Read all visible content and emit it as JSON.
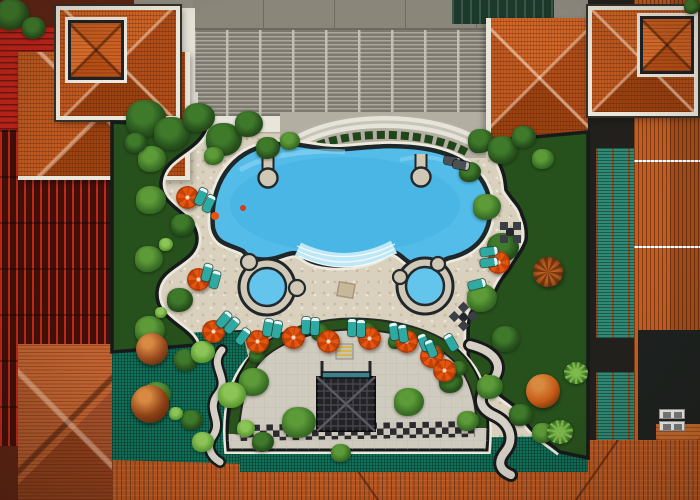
{
  "scene": {
    "description": "Aerial top-down drone photo of a tropical resort courtyard: free-form turquoise swimming pool with curved steps and two round jacuzzis, travertine sun deck with orange umbrellas and teal loungers, lush gardens, a semicircular lower courtyard with a dark pergola lattice and checkerboard path, framed by orange terracotta tower roofs, red and orange slatted pergolas, green canopy roofs and a grey louvred service building."
  },
  "colors": {
    "deck": "#d9d1be",
    "garden_paving": "#d0cbbf",
    "pool_water": "#54bce9",
    "pool_water_deep": "#3dafe0",
    "pool_steps": "#bfe8f6",
    "pool_edge": "#1e282b",
    "coping": "#eeeade",
    "roof_orange": "#bf5621",
    "red_pergola": "#c0241a",
    "building_gray": "#8f8b81",
    "mesh_green": "#10725a",
    "veg_dark": "#27511c",
    "veg_mid": "#3a7026",
    "umbrella_orange": "#e4550f",
    "lounger_teal": "#2faaa3",
    "furniture_dark": "#3a3f45",
    "white_trim": "#e9e6da"
  },
  "objects": {
    "umbrellas": [
      {
        "x": 187,
        "y": 197
      },
      {
        "x": 198,
        "y": 279
      },
      {
        "x": 213,
        "y": 331
      },
      {
        "x": 257,
        "y": 341
      },
      {
        "x": 293,
        "y": 337
      },
      {
        "x": 328,
        "y": 341
      },
      {
        "x": 369,
        "y": 338
      },
      {
        "x": 406,
        "y": 341
      },
      {
        "x": 431,
        "y": 356
      },
      {
        "x": 444,
        "y": 370
      },
      {
        "x": 498,
        "y": 262
      }
    ],
    "cone_umbrella": {
      "x": 548,
      "y": 272,
      "d": 30
    },
    "loungers": [
      {
        "x": 201,
        "y": 196,
        "rot": 25
      },
      {
        "x": 209,
        "y": 203,
        "rot": 25
      },
      {
        "x": 207,
        "y": 272,
        "rot": 15
      },
      {
        "x": 215,
        "y": 279,
        "rot": 15
      },
      {
        "x": 224,
        "y": 319,
        "rot": 40
      },
      {
        "x": 232,
        "y": 325,
        "rot": 40
      },
      {
        "x": 243,
        "y": 336,
        "rot": 35
      },
      {
        "x": 268,
        "y": 327,
        "rot": 10
      },
      {
        "x": 277,
        "y": 329,
        "rot": 10
      },
      {
        "x": 306,
        "y": 325,
        "rot": 3
      },
      {
        "x": 315,
        "y": 326,
        "rot": 3
      },
      {
        "x": 352,
        "y": 327,
        "rot": 0
      },
      {
        "x": 361,
        "y": 328,
        "rot": 0
      },
      {
        "x": 394,
        "y": 331,
        "rot": -8
      },
      {
        "x": 403,
        "y": 333,
        "rot": -8
      },
      {
        "x": 424,
        "y": 342,
        "rot": -22
      },
      {
        "x": 431,
        "y": 348,
        "rot": -22
      },
      {
        "x": 451,
        "y": 342,
        "rot": -30
      },
      {
        "x": 489,
        "y": 251,
        "rot": 82
      },
      {
        "x": 489,
        "y": 262,
        "rot": 82
      },
      {
        "x": 477,
        "y": 284,
        "rot": 76
      }
    ],
    "dark_loungers": [
      {
        "x": 452,
        "y": 161,
        "rot": 100
      },
      {
        "x": 461,
        "y": 165,
        "rot": 100
      }
    ],
    "table_sets": [
      {
        "x": 510,
        "y": 232,
        "rot": 0
      },
      {
        "x": 463,
        "y": 316,
        "rot": 45
      }
    ],
    "spheres": [
      {
        "x": 152,
        "y": 349,
        "d": 32,
        "color": "#9a4a1e"
      },
      {
        "x": 150,
        "y": 404,
        "d": 38,
        "color": "#8d4015"
      },
      {
        "x": 543,
        "y": 391,
        "d": 34,
        "color": "#c65a17"
      }
    ],
    "ac_units": [
      {
        "x": 672,
        "y": 414
      },
      {
        "x": 672,
        "y": 426
      }
    ],
    "trees": [
      {
        "x": 12,
        "y": 14,
        "d": 34,
        "v": "dark"
      },
      {
        "x": 34,
        "y": 28,
        "d": 24,
        "v": "dark"
      },
      {
        "x": 692,
        "y": 6,
        "d": 16,
        "v": "dark"
      },
      {
        "x": 146,
        "y": 118,
        "d": 40,
        "v": "dark"
      },
      {
        "x": 172,
        "y": 133,
        "d": 36,
        "v": "dark"
      },
      {
        "x": 199,
        "y": 117,
        "d": 32,
        "v": "dark"
      },
      {
        "x": 224,
        "y": 139,
        "d": 36,
        "v": "dark"
      },
      {
        "x": 249,
        "y": 124,
        "d": 28,
        "v": "dark"
      },
      {
        "x": 268,
        "y": 148,
        "d": 24,
        "v": "dark"
      },
      {
        "x": 152,
        "y": 159,
        "d": 28,
        "v": "mid"
      },
      {
        "x": 136,
        "y": 143,
        "d": 22,
        "v": "dark"
      },
      {
        "x": 290,
        "y": 141,
        "d": 20,
        "v": "mid"
      },
      {
        "x": 214,
        "y": 156,
        "d": 20,
        "v": "mid"
      },
      {
        "x": 481,
        "y": 141,
        "d": 26,
        "v": "dark"
      },
      {
        "x": 503,
        "y": 150,
        "d": 30,
        "v": "dark"
      },
      {
        "x": 524,
        "y": 137,
        "d": 24,
        "v": "dark"
      },
      {
        "x": 543,
        "y": 159,
        "d": 22,
        "v": "mid"
      },
      {
        "x": 470,
        "y": 172,
        "d": 22,
        "v": "dark"
      },
      {
        "x": 487,
        "y": 207,
        "d": 28,
        "v": "mid"
      },
      {
        "x": 503,
        "y": 247,
        "d": 32,
        "v": "dark"
      },
      {
        "x": 482,
        "y": 298,
        "d": 30,
        "v": "mid"
      },
      {
        "x": 506,
        "y": 339,
        "d": 28,
        "v": "dark"
      },
      {
        "x": 490,
        "y": 387,
        "d": 26,
        "v": "mid"
      },
      {
        "x": 521,
        "y": 415,
        "d": 24,
        "v": "dark"
      },
      {
        "x": 543,
        "y": 433,
        "d": 22,
        "v": "mid"
      },
      {
        "x": 151,
        "y": 200,
        "d": 30,
        "v": "mid"
      },
      {
        "x": 183,
        "y": 225,
        "d": 24,
        "v": "dark"
      },
      {
        "x": 149,
        "y": 259,
        "d": 28,
        "v": "mid"
      },
      {
        "x": 180,
        "y": 300,
        "d": 26,
        "v": "dark"
      },
      {
        "x": 150,
        "y": 330,
        "d": 30,
        "v": "mid"
      },
      {
        "x": 186,
        "y": 360,
        "d": 24,
        "v": "dark"
      },
      {
        "x": 157,
        "y": 395,
        "d": 28,
        "v": "mid"
      },
      {
        "x": 192,
        "y": 420,
        "d": 22,
        "v": "dark"
      },
      {
        "x": 166,
        "y": 244,
        "d": 14,
        "v": "light"
      },
      {
        "x": 161,
        "y": 312,
        "d": 12,
        "v": "light"
      },
      {
        "x": 176,
        "y": 413,
        "d": 14,
        "v": "light"
      },
      {
        "x": 254,
        "y": 382,
        "d": 30,
        "v": "mid"
      },
      {
        "x": 299,
        "y": 422,
        "d": 34,
        "v": "mid"
      },
      {
        "x": 263,
        "y": 442,
        "d": 22,
        "v": "dark"
      },
      {
        "x": 409,
        "y": 402,
        "d": 30,
        "v": "mid"
      },
      {
        "x": 451,
        "y": 382,
        "d": 24,
        "v": "dark"
      },
      {
        "x": 468,
        "y": 421,
        "d": 22,
        "v": "mid"
      },
      {
        "x": 435,
        "y": 353,
        "d": 18,
        "v": "dark"
      },
      {
        "x": 290,
        "y": 337,
        "d": 16,
        "v": "dark"
      },
      {
        "x": 320,
        "y": 332,
        "d": 18,
        "v": "dark"
      },
      {
        "x": 367,
        "y": 331,
        "d": 18,
        "v": "dark"
      },
      {
        "x": 396,
        "y": 341,
        "d": 16,
        "v": "dark"
      },
      {
        "x": 257,
        "y": 355,
        "d": 16,
        "v": "dark"
      },
      {
        "x": 459,
        "y": 368,
        "d": 16,
        "v": "dark"
      },
      {
        "x": 341,
        "y": 453,
        "d": 20,
        "v": "mid"
      },
      {
        "x": 203,
        "y": 352,
        "d": 24,
        "v": "light"
      },
      {
        "x": 232,
        "y": 395,
        "d": 28,
        "v": "light"
      },
      {
        "x": 203,
        "y": 442,
        "d": 22,
        "v": "light"
      },
      {
        "x": 246,
        "y": 428,
        "d": 18,
        "v": "light"
      },
      {
        "x": 560,
        "y": 432,
        "d": 26,
        "v": "palm"
      },
      {
        "x": 576,
        "y": 373,
        "d": 24,
        "v": "palm"
      }
    ]
  }
}
